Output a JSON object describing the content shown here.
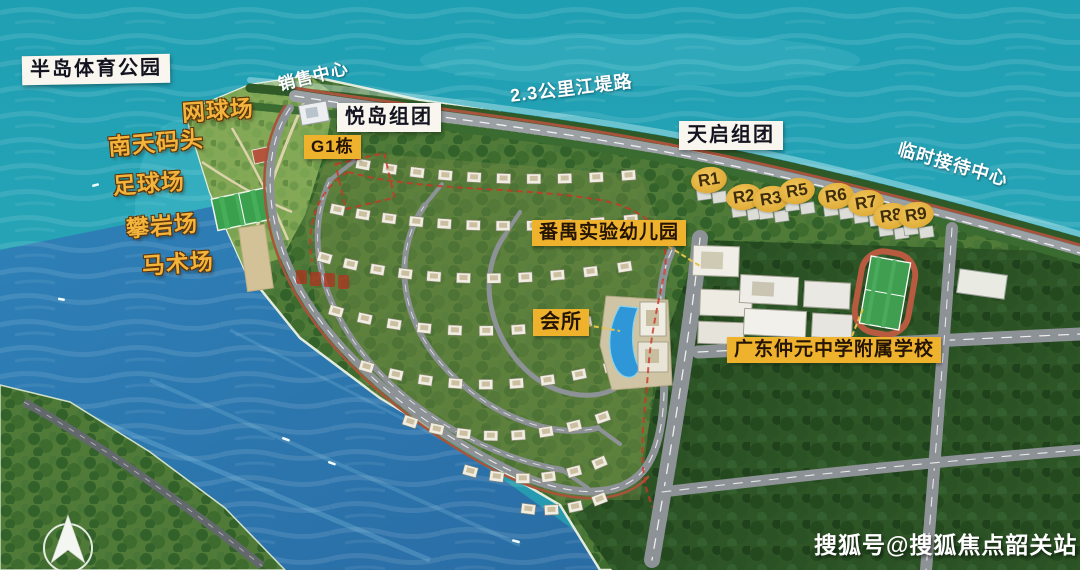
{
  "labels": {
    "park_title": "半岛体育公园",
    "facilities": [
      "网球场",
      "南天码头",
      "足球场",
      "攀岩场",
      "马术场"
    ],
    "sales_center": "销售中心",
    "yuedao_group": "悦岛组团",
    "g1_building": "G1栋",
    "river_road": "2.3公里江堤路",
    "tianqi_group": "天启组团",
    "temp_reception": "临时接待中心",
    "r_buildings": [
      "R1",
      "R2",
      "R3",
      "R5",
      "R6",
      "R7",
      "R8",
      "R9"
    ],
    "kindergarten": "番禺实验幼儿园",
    "clubhouse": "会所",
    "school": "广东仲元中学附属学校"
  },
  "watermark": "搜狐号@搜狐焦点韶关站",
  "colors": {
    "water_teal": "#1f9fb2",
    "channel_blue": "#2e7cb4",
    "land_green": "#4f7a38",
    "label_yellow": "#efb22c",
    "label_white": "#f8f6ee",
    "gold_text": "#f2b43c",
    "track_red": "#a8543c"
  },
  "compass": {
    "direction": "north"
  }
}
